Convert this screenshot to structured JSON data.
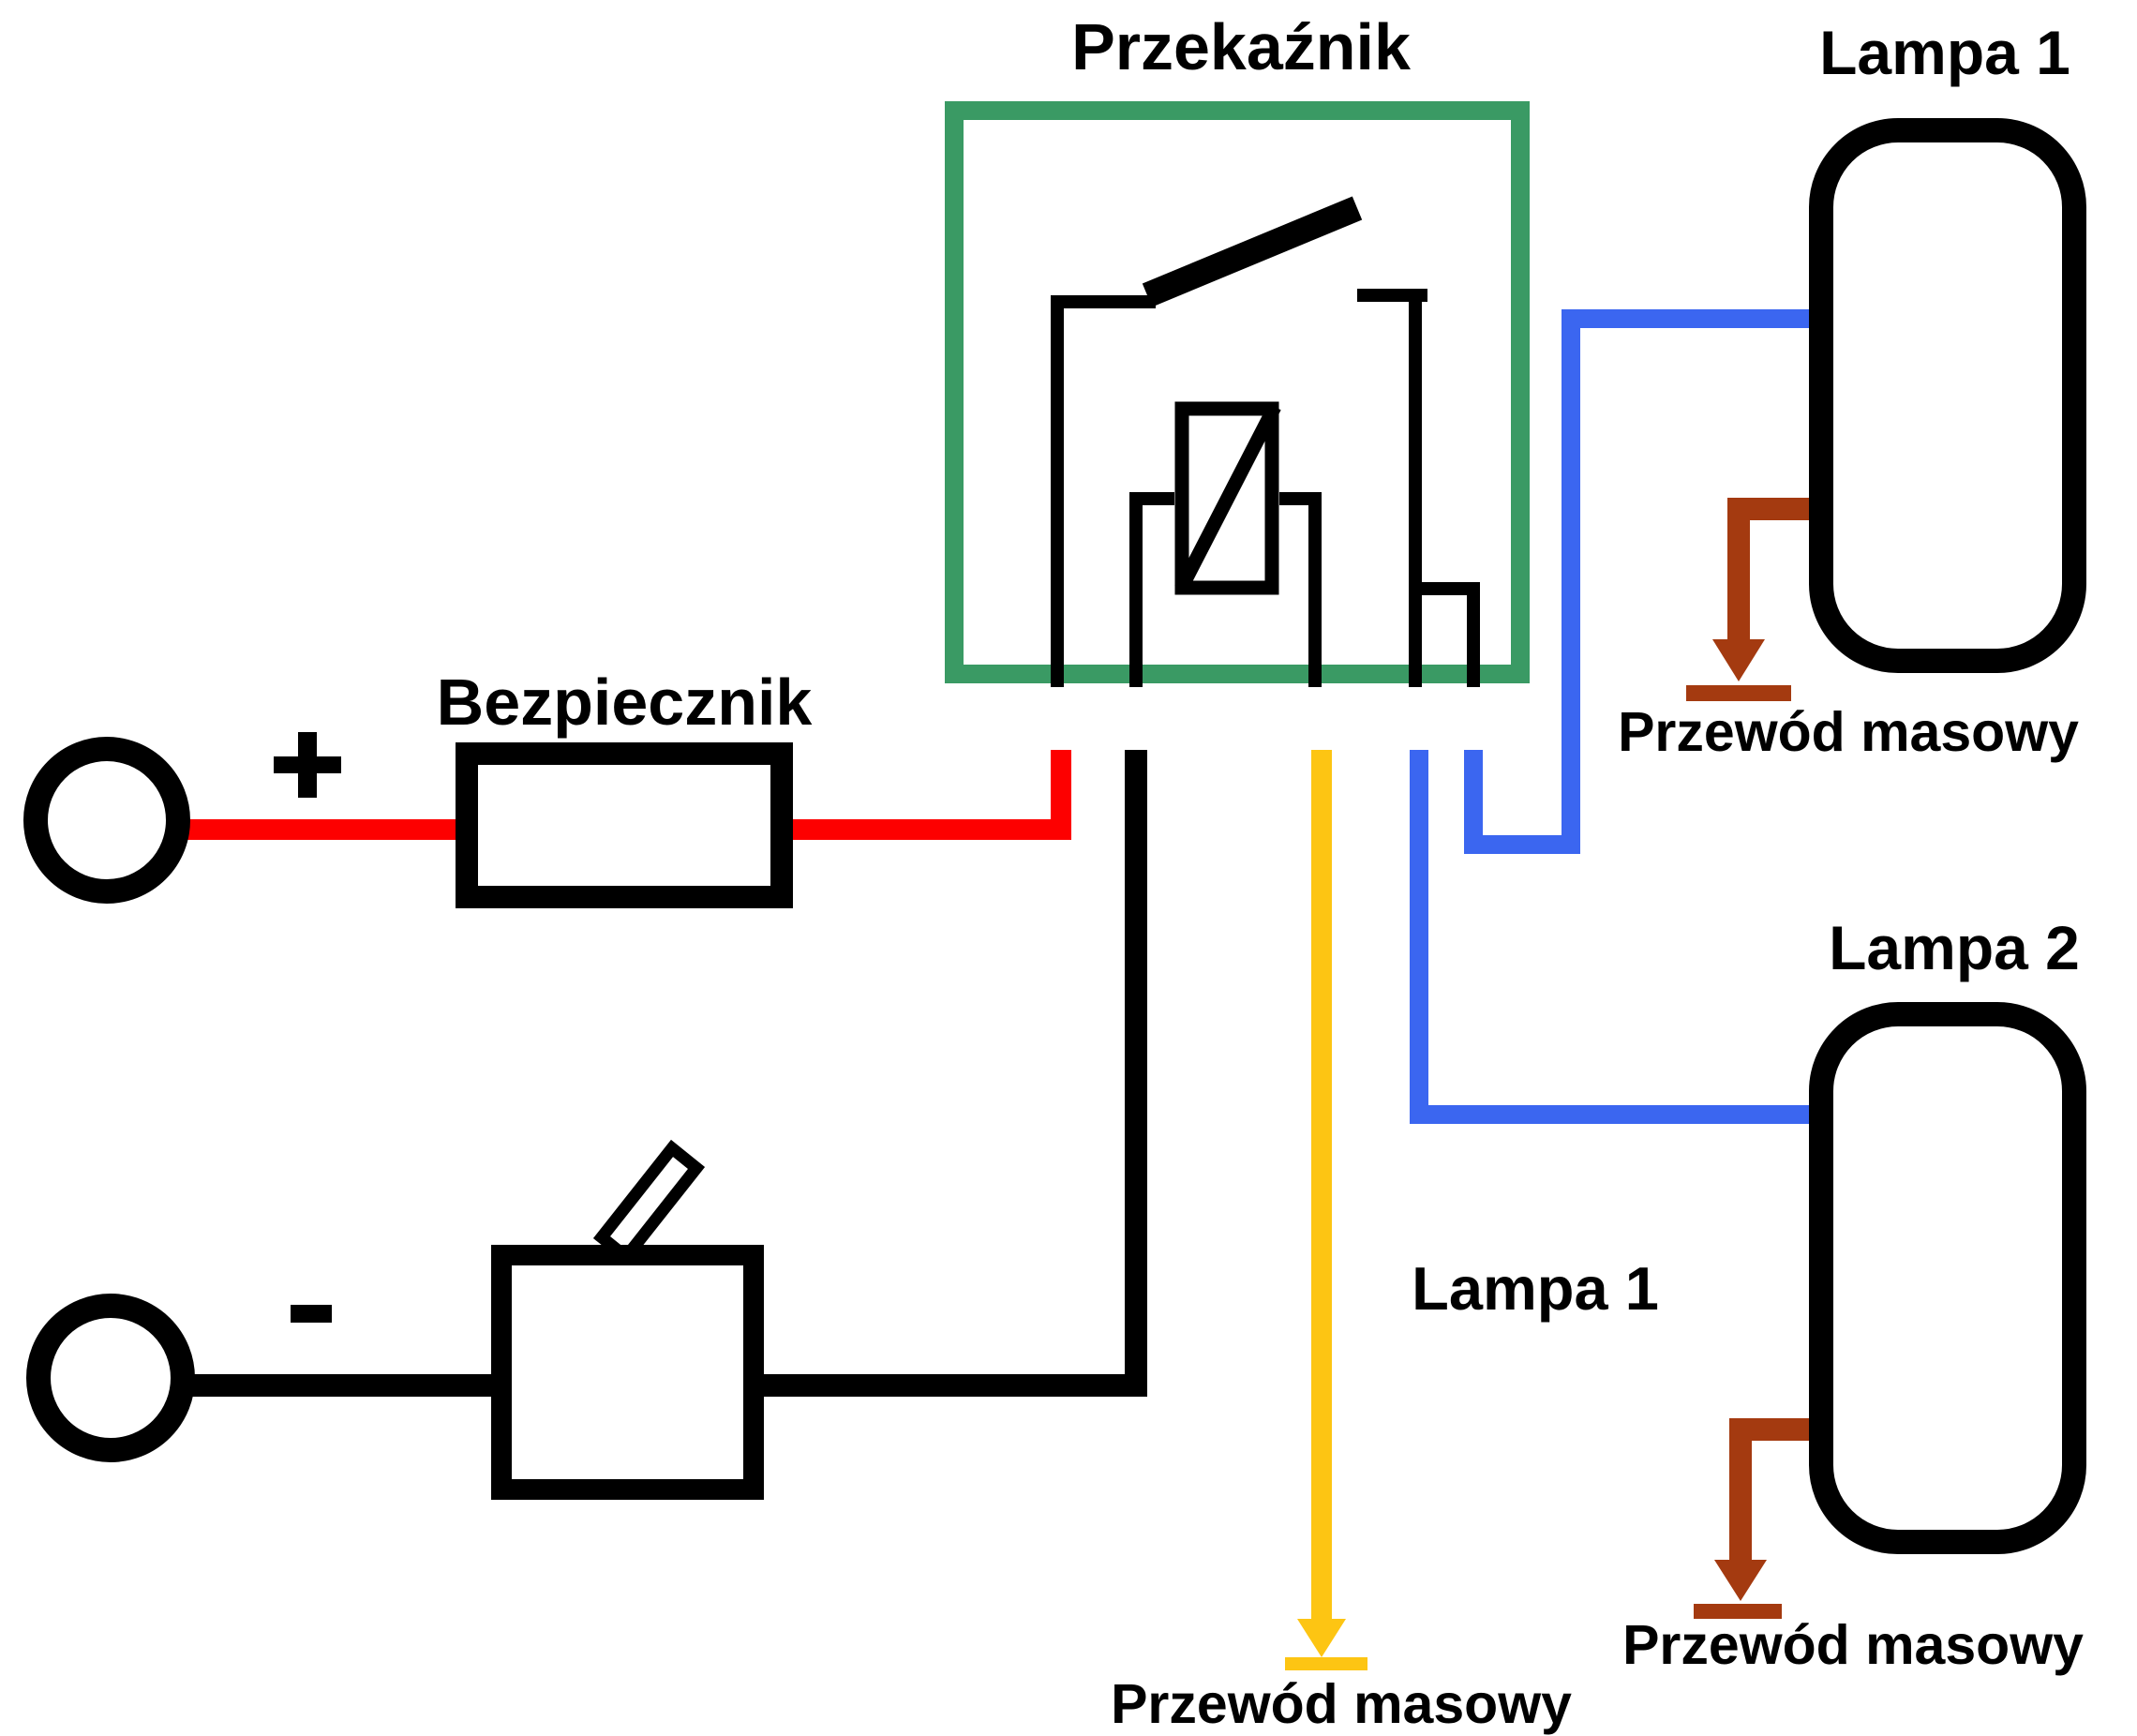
{
  "diagram": {
    "relay": {
      "label": "Przekaźnik"
    },
    "fuse": {
      "label": "Bezpiecznik"
    },
    "lamp1": {
      "label": "Lampa 1"
    },
    "lamp2": {
      "label": "Lampa 2"
    },
    "wire_to_lamp1": {
      "label": "Lampa 1"
    },
    "battery": {
      "plus": "+",
      "minus": "-"
    },
    "grounds": {
      "lamp1_ground_label": "Przewód masowy",
      "lamp2_ground_label": "Przewód masowy",
      "relay_coil_ground_label": "Przewód masowy"
    }
  },
  "colors": {
    "background": "#ffffff",
    "text": "#000000",
    "wire_black": "#000000",
    "wire_red": "#fd0000",
    "relay_green": "#3a9a64",
    "wire_blue": "#3b66f0",
    "wire_yellow": "#fdc513",
    "wire_brown": "#a43a10",
    "component_fill": "#ffffff"
  }
}
